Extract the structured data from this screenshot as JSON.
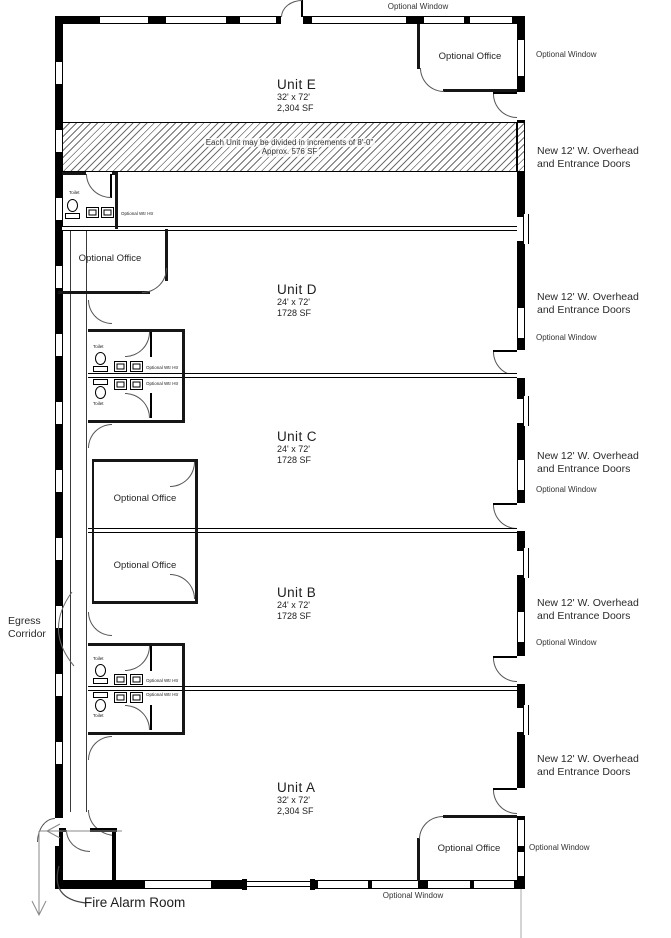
{
  "units": [
    {
      "name": "Unit E",
      "dims": "32' x 72'",
      "area": "2,304 SF"
    },
    {
      "name": "Unit D",
      "dims": "24' x 72'",
      "area": "1728 SF"
    },
    {
      "name": "Unit C",
      "dims": "24' x 72'",
      "area": "1728 SF"
    },
    {
      "name": "Unit B",
      "dims": "24' x 72'",
      "area": "1728 SF"
    },
    {
      "name": "Unit A",
      "dims": "32' x 72'",
      "area": "2,304 SF"
    }
  ],
  "labels": {
    "optional_office": "Optional Office",
    "optional_window": "Optional Window",
    "overhead_doors": "New 12' W. Overhead\nand Entrance Doors",
    "egress_corridor": "Egress\nCorridor",
    "fire_alarm_room": "Fire Alarm Room",
    "toilet": "Toilet",
    "water_heater": "Optional Wtr Htr",
    "divisible_note_line1": "Each Unit may be divided in increments of 8'-0\"",
    "divisible_note_line2": "Approx. 576 SF"
  },
  "colors": {
    "line": "#000000",
    "text": "#2b2b2b",
    "hatch": "#6f6f6f"
  }
}
